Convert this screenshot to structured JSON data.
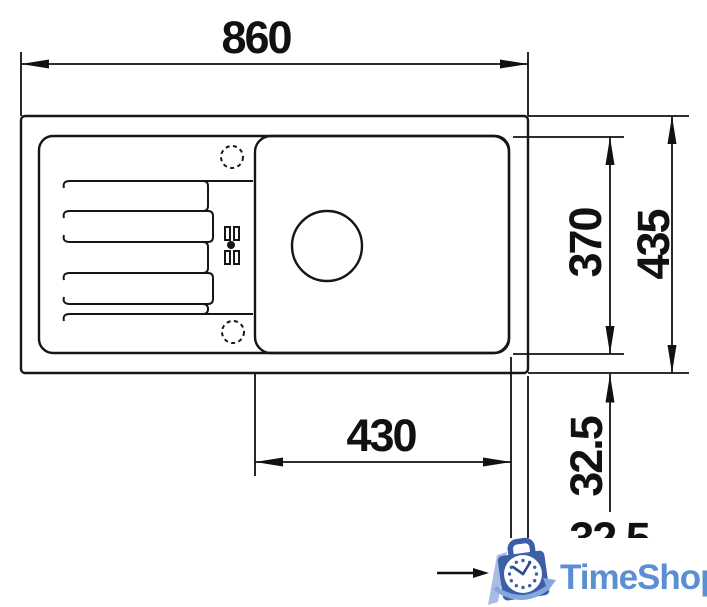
{
  "drawing": {
    "type": "sink-technical-drawing-top-view",
    "dim_overall_width": "860",
    "dim_bowl_width": "430",
    "dim_bowl_depth": "370",
    "dim_overall_depth": "435",
    "dim_offset_bottom": "32.5",
    "dim_offset_right_partial": "32.5"
  },
  "watermark": {
    "brand": "TimeShop"
  },
  "colors": {
    "line": "#161616",
    "logo_text_blue": "#5b8ed2",
    "logo_bag_blue": "#3d5fa8",
    "logo_light_blue": "#84a7de",
    "logo_slash_blue": "#a8bce4",
    "background": "#ffffff"
  }
}
